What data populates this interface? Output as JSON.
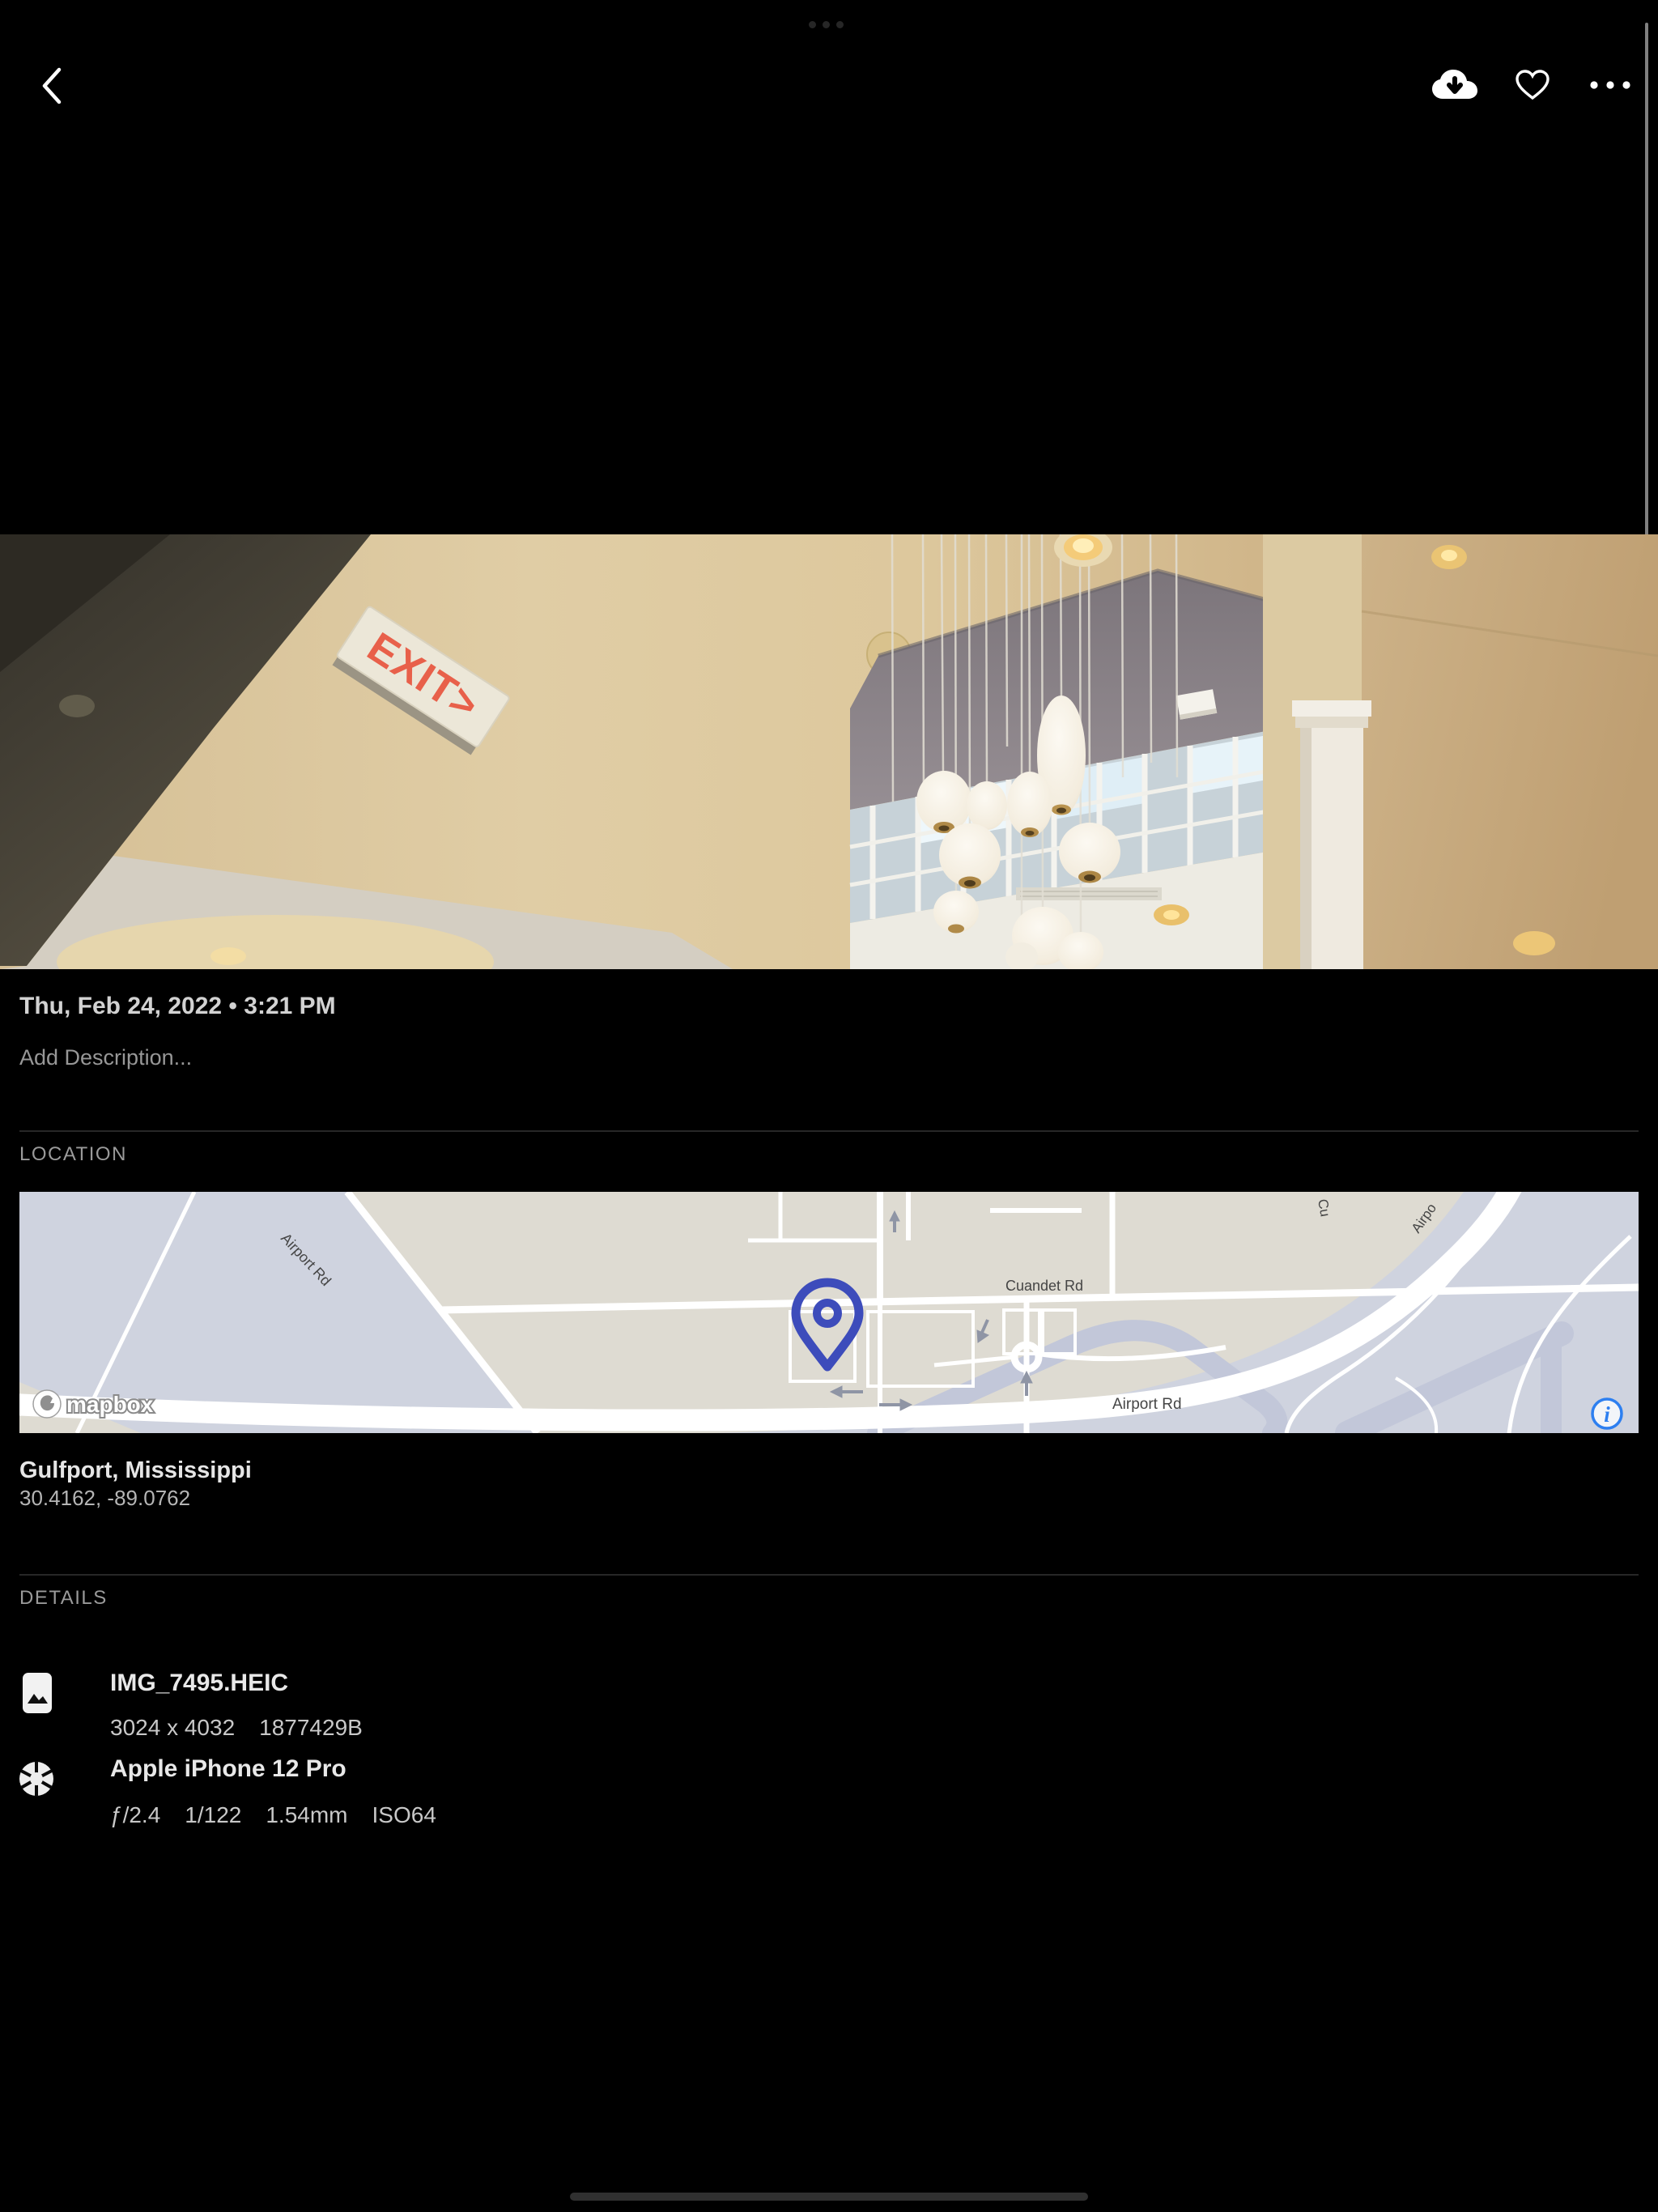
{
  "toolbar": {
    "back_icon": "chevron-left",
    "download_icon": "cloud-arrow-down",
    "favorite_icon": "heart-outline",
    "more_icon": "ellipsis"
  },
  "photo": {
    "date_line": "Thu, Feb 24, 2022 • 3:21 PM",
    "description_placeholder": "Add Description...",
    "exit_sign_text": "EXIT>"
  },
  "location": {
    "header": "LOCATION",
    "place": "Gulfport, Mississippi",
    "coordinates": "30.4162, -89.0762",
    "map": {
      "label_airport_rd_diagonal": "Airport Rd",
      "label_cuandet_rd": "Cuandet Rd",
      "label_airport_rd_main": "Airport Rd",
      "label_partial_airport": "Airpo",
      "label_partial_cu": "Cu",
      "attribution": "mapbox",
      "info_glyph": "i",
      "pin_color": "#3d4cbb",
      "info_color": "#2d7ff0",
      "land_color": "#dedbd2",
      "field_color": "#cfd3df"
    }
  },
  "details": {
    "header": "DETAILS",
    "file": {
      "name": "IMG_7495.HEIC",
      "dimensions": "3024 x 4032",
      "size": "1877429B"
    },
    "camera": {
      "name": "Apple iPhone 12 Pro",
      "settings": [
        "ƒ/2.4",
        "1/122",
        "1.54mm",
        "ISO64"
      ]
    }
  }
}
